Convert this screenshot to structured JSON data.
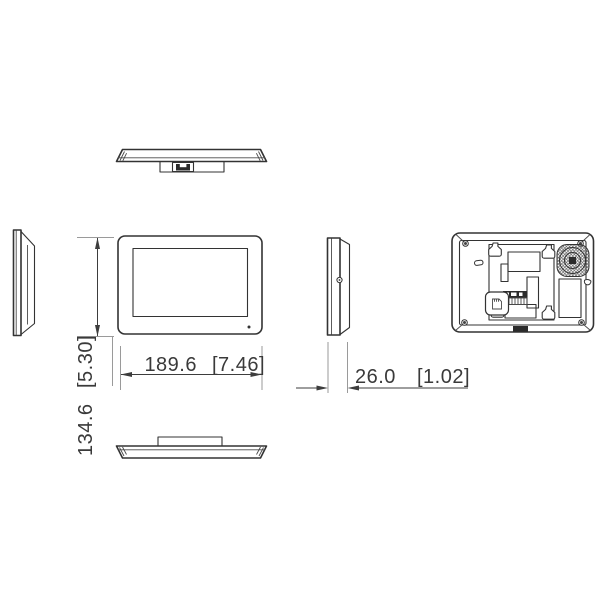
{
  "drawing": {
    "background": "#ffffff",
    "colors": {
      "line": "#333333",
      "dimension_line": "#3d3d3d",
      "extension_line": "#9a9a9a",
      "text": "#3a3a3a",
      "dark_fill": "#2b2b2b"
    },
    "dimensions": {
      "width": {
        "mm": "189.6",
        "inches": "[7.46]"
      },
      "height": {
        "mm": "134.6",
        "inches": "[5.30]"
      },
      "depth": {
        "mm": "26.0",
        "inches": "[1.02]"
      }
    },
    "icons": {
      "keyhole-mount-slot": "keyhole-flask-shape",
      "speaker-grille": "crosshatched-circle",
      "terminal-block": "dark-pin-strip",
      "sd-card-slot": "card-glyph-in-rounded-square",
      "corner-screw": "filled-dot-with-tick",
      "mic-hole": "small-dot",
      "screw-hole": "circle-with-dot",
      "hanging-hole": "teardrop",
      "cable-slot": "small-oval",
      "cable-connector": "u-shaped-socket"
    }
  }
}
